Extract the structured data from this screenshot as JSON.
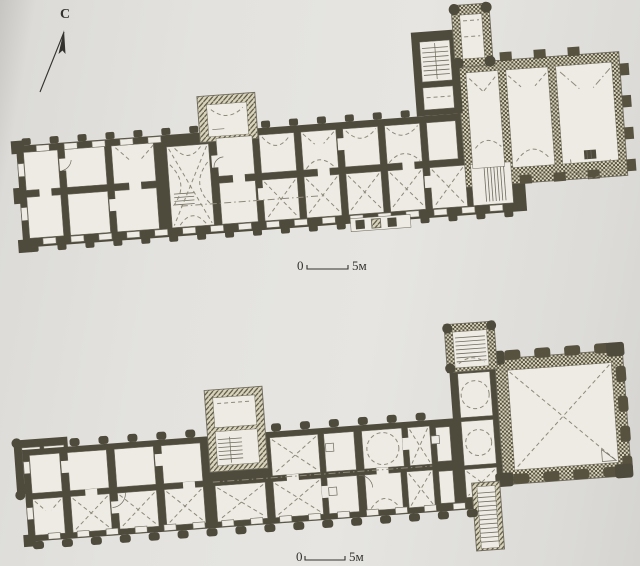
{
  "north_indicator": {
    "label": "С"
  },
  "scale_bars": [
    {
      "zero": "0",
      "length_label": "5м"
    },
    {
      "zero": "0",
      "length_label": "5м"
    }
  ],
  "colors": {
    "paper": "#e3e2de",
    "wall_solid": "#4e4a3c",
    "wall_hatch_dark": "#575240",
    "wall_hatch_light": "#d9d4bc",
    "room": "#edebe4",
    "line": "#6f6b5e",
    "dash": "#8f897a",
    "ink": "#33322e"
  }
}
